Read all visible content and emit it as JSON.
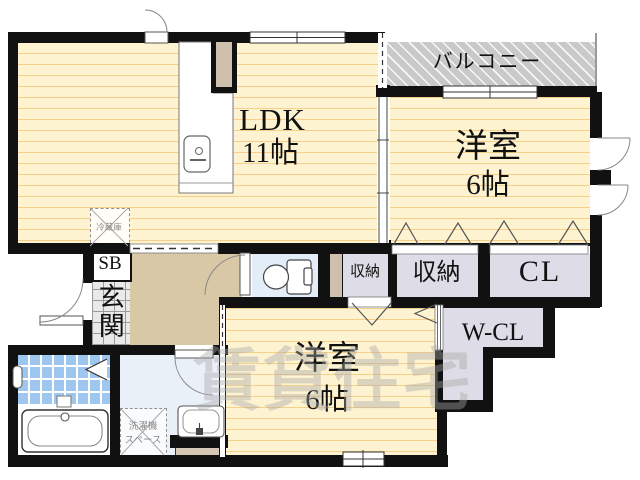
{
  "floorplan": {
    "watermark": "賃貸住宅",
    "rooms": {
      "ldk": {
        "label": "LDK",
        "size": "11帖"
      },
      "bedroom1": {
        "label": "洋室",
        "size": "6帖"
      },
      "bedroom2": {
        "label": "洋室",
        "size": "6帖"
      },
      "balcony": {
        "label": "バルコニー"
      },
      "genkan": {
        "label": "玄関"
      },
      "shoe_box": {
        "label": "SB"
      },
      "storage_small": {
        "label": "収納"
      },
      "storage": {
        "label": "収納"
      },
      "closet": {
        "label": "CL"
      },
      "walk_in_closet": {
        "label": "W-CL"
      }
    },
    "fixtures": {
      "refrigerator": {
        "label": "冷蔵庫"
      },
      "washer_space": {
        "label": "洗濯機\nスペース"
      }
    },
    "colors": {
      "wall": "#111111",
      "floor_yellow": "#fdf3d0",
      "floor_stripe": "#f0b45a",
      "balcony_gray": "#c9c9c9",
      "closet_gray": "#dedce6",
      "hallway_beige": "#d9c8a6",
      "bath_tile_blue": "#9ec7ef",
      "watermark_gray": "#a8a8a8"
    }
  }
}
